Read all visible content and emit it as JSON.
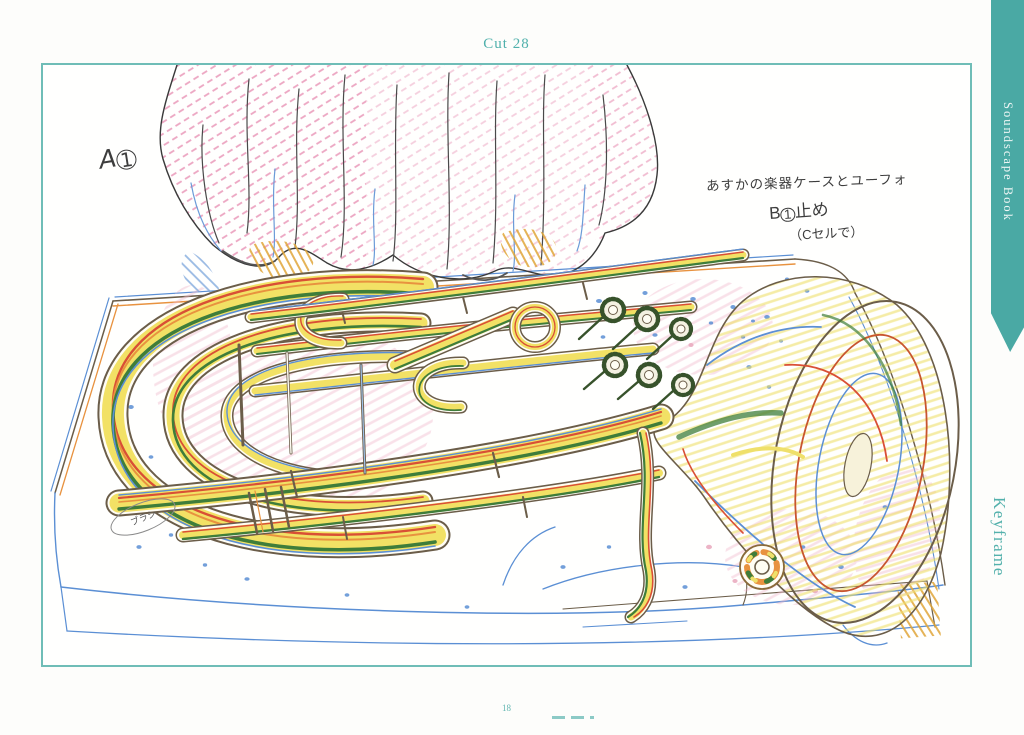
{
  "page": {
    "cut_label": "Cut 28",
    "page_number": "18"
  },
  "spine": {
    "series_title": "Soundscape Book",
    "section_title": "Keyframe"
  },
  "annotations": {
    "cel_label_letter": "A",
    "cel_label_number": "1",
    "note_line1": "あすかの楽器ケースとユーフォ",
    "note_line2_letter": "B",
    "note_line2_number": "1",
    "note_line2_text": "止め",
    "note_line3": "（Cセルで）",
    "bubble_note": "ブラシ"
  },
  "colors": {
    "teal_ribbon": "#4aa9a4",
    "teal_text": "#52b0ab",
    "frame_border": "#6fbdb7",
    "pencil_outline": "#6b5d49",
    "pencil_pink": "#e06a9a",
    "pencil_yellow": "#f2e165",
    "pencil_orange": "#e8923f",
    "pencil_red": "#d94f35",
    "pencil_green": "#3f7d3a",
    "pencil_blue": "#5b8fd4"
  }
}
